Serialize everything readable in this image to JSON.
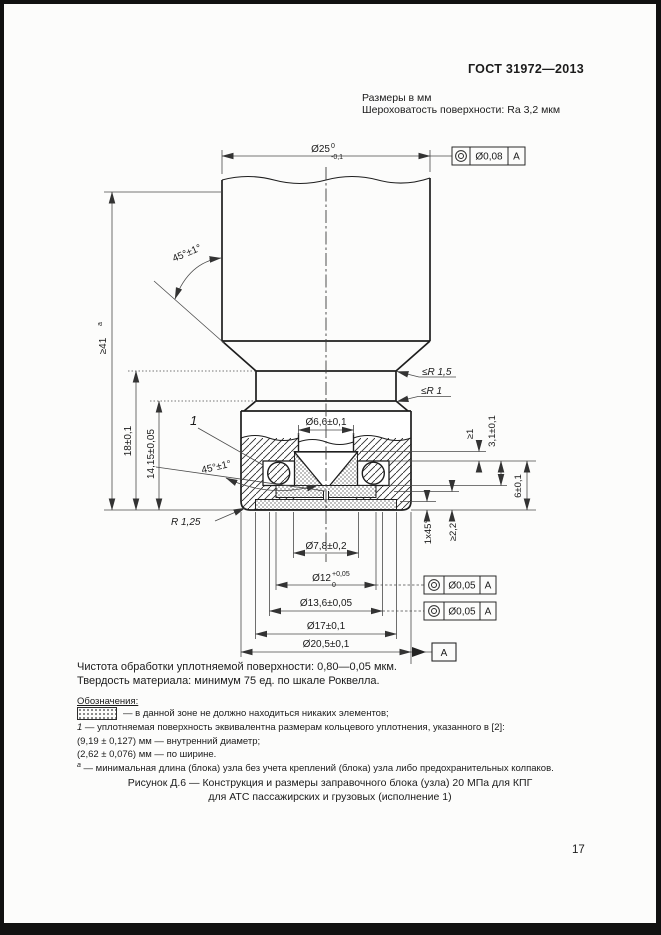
{
  "header": {
    "doc_code": "ГОСТ 31972—2013",
    "units_note": "Размеры в мм",
    "roughness_note": "Шероховатость поверхности: Ra 3,2 мкм"
  },
  "dims": {
    "d25_main": "Ø25",
    "d25_sup": "0",
    "d25_sub": "-0,1",
    "fcf_top_tol": "Ø0,08",
    "fcf_top_datum": "A",
    "len41": "≥41",
    "len41_sup": "а",
    "len18": "18±0,1",
    "len1415": "14,15±0,05",
    "angle_top": "45°±1°",
    "angle_mid": "45°±1°",
    "r15": "≤R 1,5",
    "r1": "≤R 1",
    "pos1": "1",
    "r125": "R 1,25",
    "d66": "Ø6,6±0,1",
    "ge1": "≥1",
    "h31": "3,1±0,1",
    "h6": "6±0,1",
    "ch145": "1x45°",
    "ge22": "≥2,2",
    "d78": "Ø7,8±0,2",
    "d12_main": "Ø12",
    "d12_sup": "+0,05",
    "d12_sub": "0",
    "d136": "Ø13,6±0,05",
    "d17": "Ø17±0,1",
    "d205": "Ø20,5±0,1",
    "fcf1_tol": "Ø0,05",
    "fcf1_datum": "A",
    "fcf2_tol": "Ø0,05",
    "fcf2_datum": "A",
    "datum_flag": "A"
  },
  "notes": {
    "line1": "Чистота обработки уплотняемой поверхности: 0,80—0,05 мкм.",
    "line2": "Твердость материала: минимум 75 ед. по шкале Роквелла.",
    "legend_title": "Обозначения:",
    "legend_stipple": "— в данной зоне не должно находиться никаких элементов;",
    "item1_prefix": "1",
    "item1": " — уплотняемая поверхность эквивалентна размерам кольцевого уплотнения, указанного в [2]:",
    "item2": "(9,19 ± 0,127) мм — внутренний диаметр;",
    "item3": "(2,62 ± 0,076) мм — по ширине.",
    "item4_prefix": "а",
    "item4": " — минимальная длина (блока) узла без учета креплений (блока) узла либо предохранительных колпаков."
  },
  "caption": {
    "line1": "Рисунок Д.6 — Конструкция и размеры заправочного блока (узла) 20 МПа для КПГ",
    "line2": "для АТС пассажирских и грузовых (исполнение 1)"
  },
  "page": {
    "number": "17"
  }
}
